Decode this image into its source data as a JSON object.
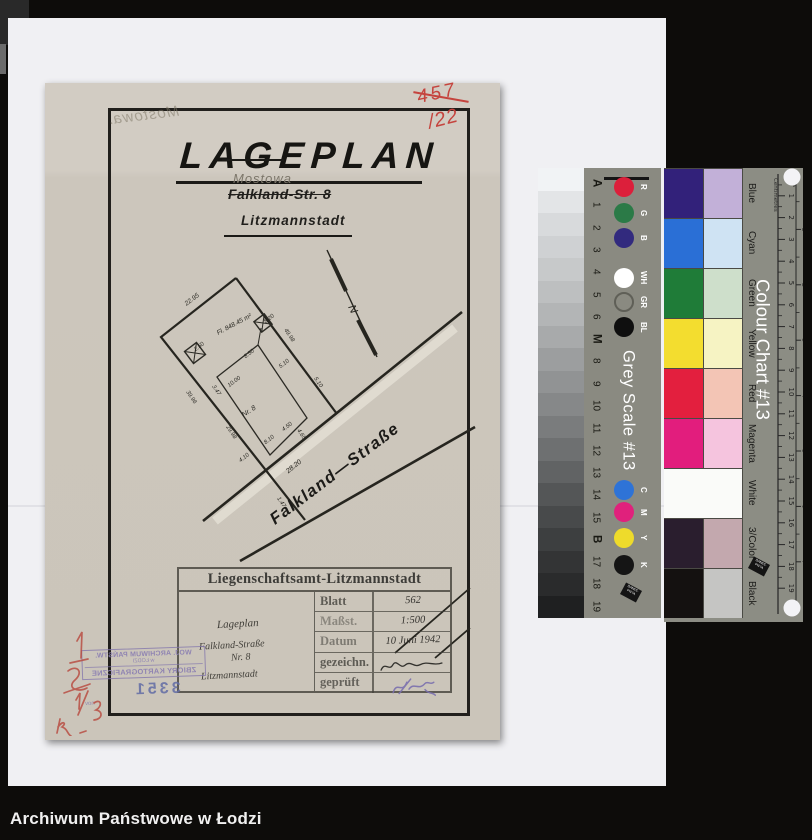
{
  "page": {
    "caption": "Archiwum Państwowe w Łodzi"
  },
  "document": {
    "title": "LAGEPLAN",
    "street_pencil": "Mostowa",
    "street_struck": "Falkland-Str. 8",
    "city": "Litzmannstadt",
    "ghost_pencil": "Mostowa.",
    "red_annotations": {
      "top": "457",
      "bottom": "/22"
    },
    "plan": {
      "street_label": "Falkland—Straße",
      "north_label": "N",
      "dimensions": [
        {
          "t": "22.95",
          "x": 148,
          "y": 218,
          "r": -37,
          "s": 6.5
        },
        {
          "t": "Fl. 848.45 m²",
          "x": 190,
          "y": 243,
          "r": -28,
          "s": 6.5
        },
        {
          "t": "8.20",
          "x": 225,
          "y": 237,
          "r": -37
        },
        {
          "t": "2.50",
          "x": 155,
          "y": 265,
          "r": -37
        },
        {
          "t": "8.50",
          "x": 205,
          "y": 272,
          "r": -37
        },
        {
          "t": "5.10",
          "x": 240,
          "y": 282,
          "r": -37
        },
        {
          "t": "10.00",
          "x": 190,
          "y": 300,
          "r": -37
        },
        {
          "t": "49.98",
          "x": 243,
          "y": 253,
          "r": 56
        },
        {
          "t": "5.10",
          "x": 272,
          "y": 300,
          "r": 56
        },
        {
          "t": "39.96",
          "x": 145,
          "y": 315,
          "r": 56
        },
        {
          "t": "3.47",
          "x": 170,
          "y": 308,
          "r": 56
        },
        {
          "t": "29.98",
          "x": 185,
          "y": 350,
          "r": 56
        },
        {
          "t": "Nr. 8",
          "x": 205,
          "y": 330,
          "r": -33,
          "s": 7
        },
        {
          "t": "4.50",
          "x": 243,
          "y": 345,
          "r": -37
        },
        {
          "t": "8.10",
          "x": 225,
          "y": 358,
          "r": -37
        },
        {
          "t": "4.10",
          "x": 200,
          "y": 376,
          "r": -37
        },
        {
          "t": "4.65",
          "x": 255,
          "y": 352,
          "r": 56
        },
        {
          "t": "1.47",
          "x": 235,
          "y": 420,
          "r": 56
        },
        {
          "t": "28.20",
          "x": 250,
          "y": 385,
          "r": -39,
          "s": 7
        }
      ]
    },
    "title_block": {
      "header": "Liegenschaftsamt-Litzmannstadt",
      "description_lines": [
        "Lageplan",
        "Falkland-Straße",
        "Nr. 8",
        "Litzmannstadt"
      ],
      "rows": [
        {
          "label": "Blatt",
          "value": "562",
          "signature": "none"
        },
        {
          "label": "Maßst.",
          "value": "1:500",
          "signature": "none"
        },
        {
          "label": "Datum",
          "value": "10 Juni 1942",
          "signature": "none"
        },
        {
          "label": "gezeichn.",
          "value": "",
          "signature": "ink"
        },
        {
          "label": "geprüft",
          "value": "",
          "signature": "purple"
        }
      ]
    },
    "archive_stamp": {
      "line1": "WOJ. ARCHIWUM PAŃSTW.",
      "line2": "w ŁODZI",
      "line3": "ZBIORY KARTOGRAFICZNE",
      "number": "3351",
      "note": "nov"
    }
  },
  "grey_scale_card": {
    "title": "Grey Scale #13",
    "brand": "DANES-PICTA",
    "wedge_steps": [
      "#f1f3f5",
      "#e3e5e7",
      "#d8dadc",
      "#cfd1d3",
      "#c7c9ca",
      "#bdbfc0",
      "#b3b5b6",
      "#a8aaab",
      "#9c9e9f",
      "#919394",
      "#868889",
      "#7a7c7d",
      "#6e7071",
      "#616364",
      "#545657",
      "#484a4b",
      "#3d3f40",
      "#333435",
      "#2a2b2c",
      "#1f2021"
    ],
    "markers": [
      "A",
      "1",
      "2",
      "3",
      "4",
      "5",
      "6",
      "M",
      "8",
      "9",
      "10",
      "11",
      "12",
      "13",
      "14",
      "15",
      "B",
      "17",
      "18",
      "19"
    ],
    "patches": [
      {
        "label": "R",
        "color": "#dc1f3b"
      },
      {
        "label": "G",
        "color": "#2b7a47"
      },
      {
        "label": "B",
        "color": "#322a7e"
      },
      {
        "label": "WH",
        "color": "#ffffff"
      },
      {
        "label": "GR",
        "color": "ring"
      },
      {
        "label": "BL",
        "color": "#0f0f0f"
      },
      {
        "label": "C",
        "color": "#2e73d7"
      },
      {
        "label": "M",
        "color": "#e0217c"
      },
      {
        "label": "Y",
        "color": "#eedb2b"
      },
      {
        "label": "K",
        "color": "#151515"
      }
    ]
  },
  "colour_chart_card": {
    "title": "Colour Chart #13",
    "brand": "DANES-PICTA",
    "ruler_cm_label": "Centimetres",
    "ruler_in_label": "Inches",
    "cm_max": 19,
    "inch_max": 7,
    "rows": [
      {
        "name": "Blue",
        "strong": "#32217a",
        "pale": "#c2b0d8",
        "full": false
      },
      {
        "name": "Cyan",
        "strong": "#2a6fd6",
        "pale": "#cfe3f3",
        "full": false
      },
      {
        "name": "Green",
        "strong": "#1f7c38",
        "pale": "#cedfcb",
        "full": false
      },
      {
        "name": "Yellow",
        "strong": "#f3dd2f",
        "pale": "#f6f3c3",
        "full": false
      },
      {
        "name": "Red",
        "strong": "#e31f3e",
        "pale": "#f3c5b5",
        "full": false
      },
      {
        "name": "Magenta",
        "strong": "#e21d7d",
        "pale": "#f5c4de",
        "full": false
      },
      {
        "name": "White",
        "strong": "#fafbf9",
        "pale": "#fafbf9",
        "full": true
      },
      {
        "name": "3/Color",
        "strong": "#2a1e2e",
        "pale": "#c3a8ae",
        "full": false
      },
      {
        "name": "Black",
        "strong": "#141110",
        "pale": "#c5c5c3",
        "full": false
      }
    ]
  }
}
